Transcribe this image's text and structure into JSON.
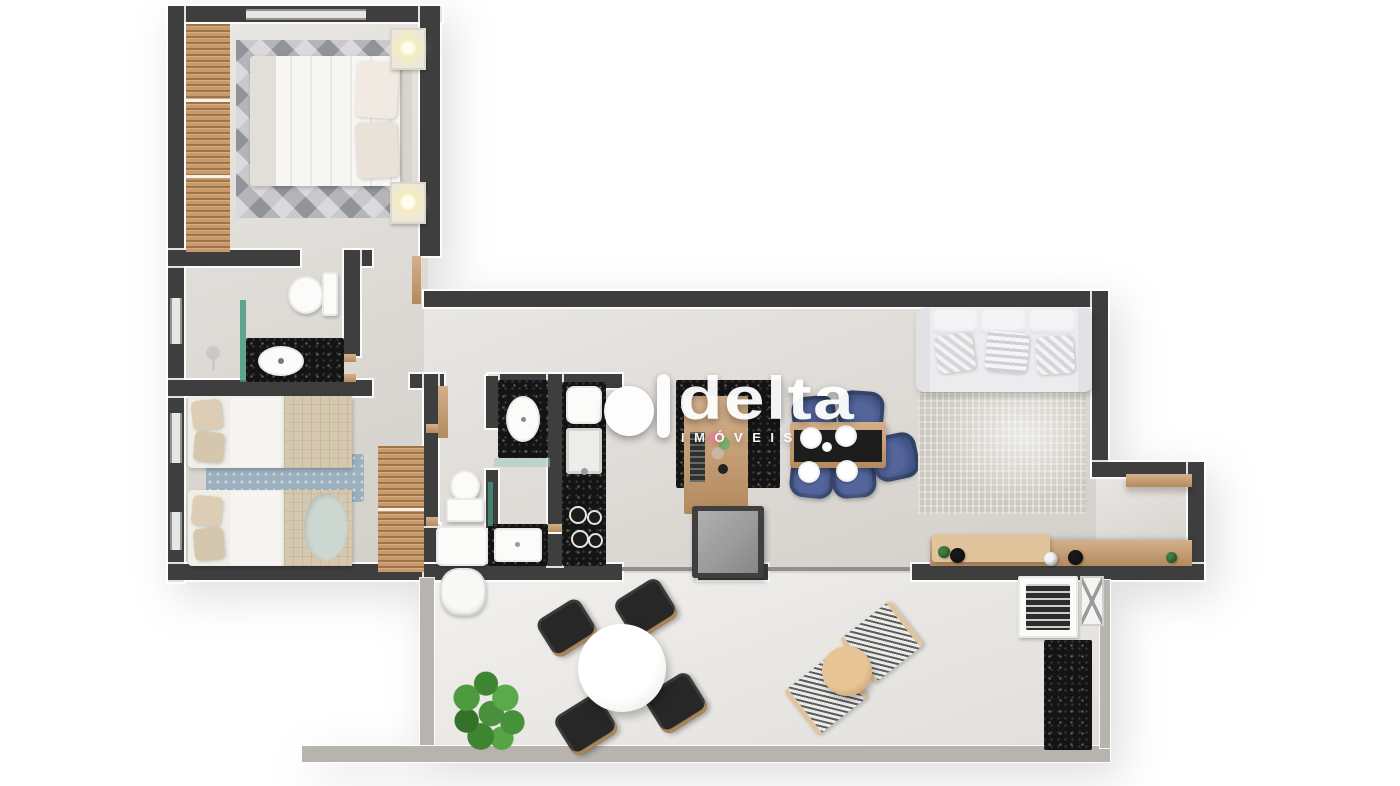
{
  "watermark": {
    "brand": "delta",
    "subtitle": "IMÓVEIS"
  },
  "colors": {
    "background": "#ffffff",
    "wall": "#3e3e3e",
    "wallLight": "#b7b4af",
    "floor": "#dedad5",
    "floorBalcony": "#e8e6e2",
    "wood": "#c89a6a",
    "woodLight": "#e0c49c",
    "granite": "#141414",
    "navy": "#3c4e7a",
    "fridge": "#9b9b9b",
    "sofa": "#ececee",
    "rugLiving": "#cdc9c0",
    "rugBedroom1": "#b4b4ba",
    "rugBedroom2": "#9db0bf",
    "plant": "#4a8f3c",
    "lamp": "#f0e6ae",
    "glassTeal": "#40967e"
  },
  "scene": {
    "kind": "3d-apartment-floor-plan-render",
    "rooms": [
      {
        "name": "bedroom-1",
        "furniture": [
          "double-bed",
          "wardrobe",
          "nightstand-lamp",
          "nightstand-lamp",
          "diamond-rug",
          "window"
        ]
      },
      {
        "name": "bathroom-1",
        "furniture": [
          "toilet",
          "granite-vanity-sink",
          "shower-glass"
        ]
      },
      {
        "name": "bedroom-2",
        "furniture": [
          "single-bed",
          "single-bed",
          "wardrobe",
          "blue-rug",
          "windows"
        ]
      },
      {
        "name": "bathroom-2",
        "furniture": [
          "toilet",
          "granite-vanity-sink",
          "shower-tray"
        ]
      },
      {
        "name": "laundry",
        "furniture": [
          "laundry-tub",
          "water-heater"
        ]
      },
      {
        "name": "kitchen",
        "furniture": [
          "granite-counter-sink-cooktop",
          "island-counter",
          "refrigerator"
        ]
      },
      {
        "name": "dining",
        "furniture": [
          "wood-table-runner",
          "navy-chairs-x5",
          "plates-x4"
        ]
      },
      {
        "name": "living",
        "furniture": [
          "sofa-3-seats",
          "textured-rug",
          "wood-sideboard",
          "wall-shelf"
        ]
      },
      {
        "name": "balcony",
        "furniture": [
          "round-table",
          "black-chairs-x4",
          "striped-loungers-x2",
          "side-table",
          "barbecue-grill",
          "granite-counter",
          "potted-plant",
          "glass-sliding-doors"
        ]
      }
    ]
  }
}
